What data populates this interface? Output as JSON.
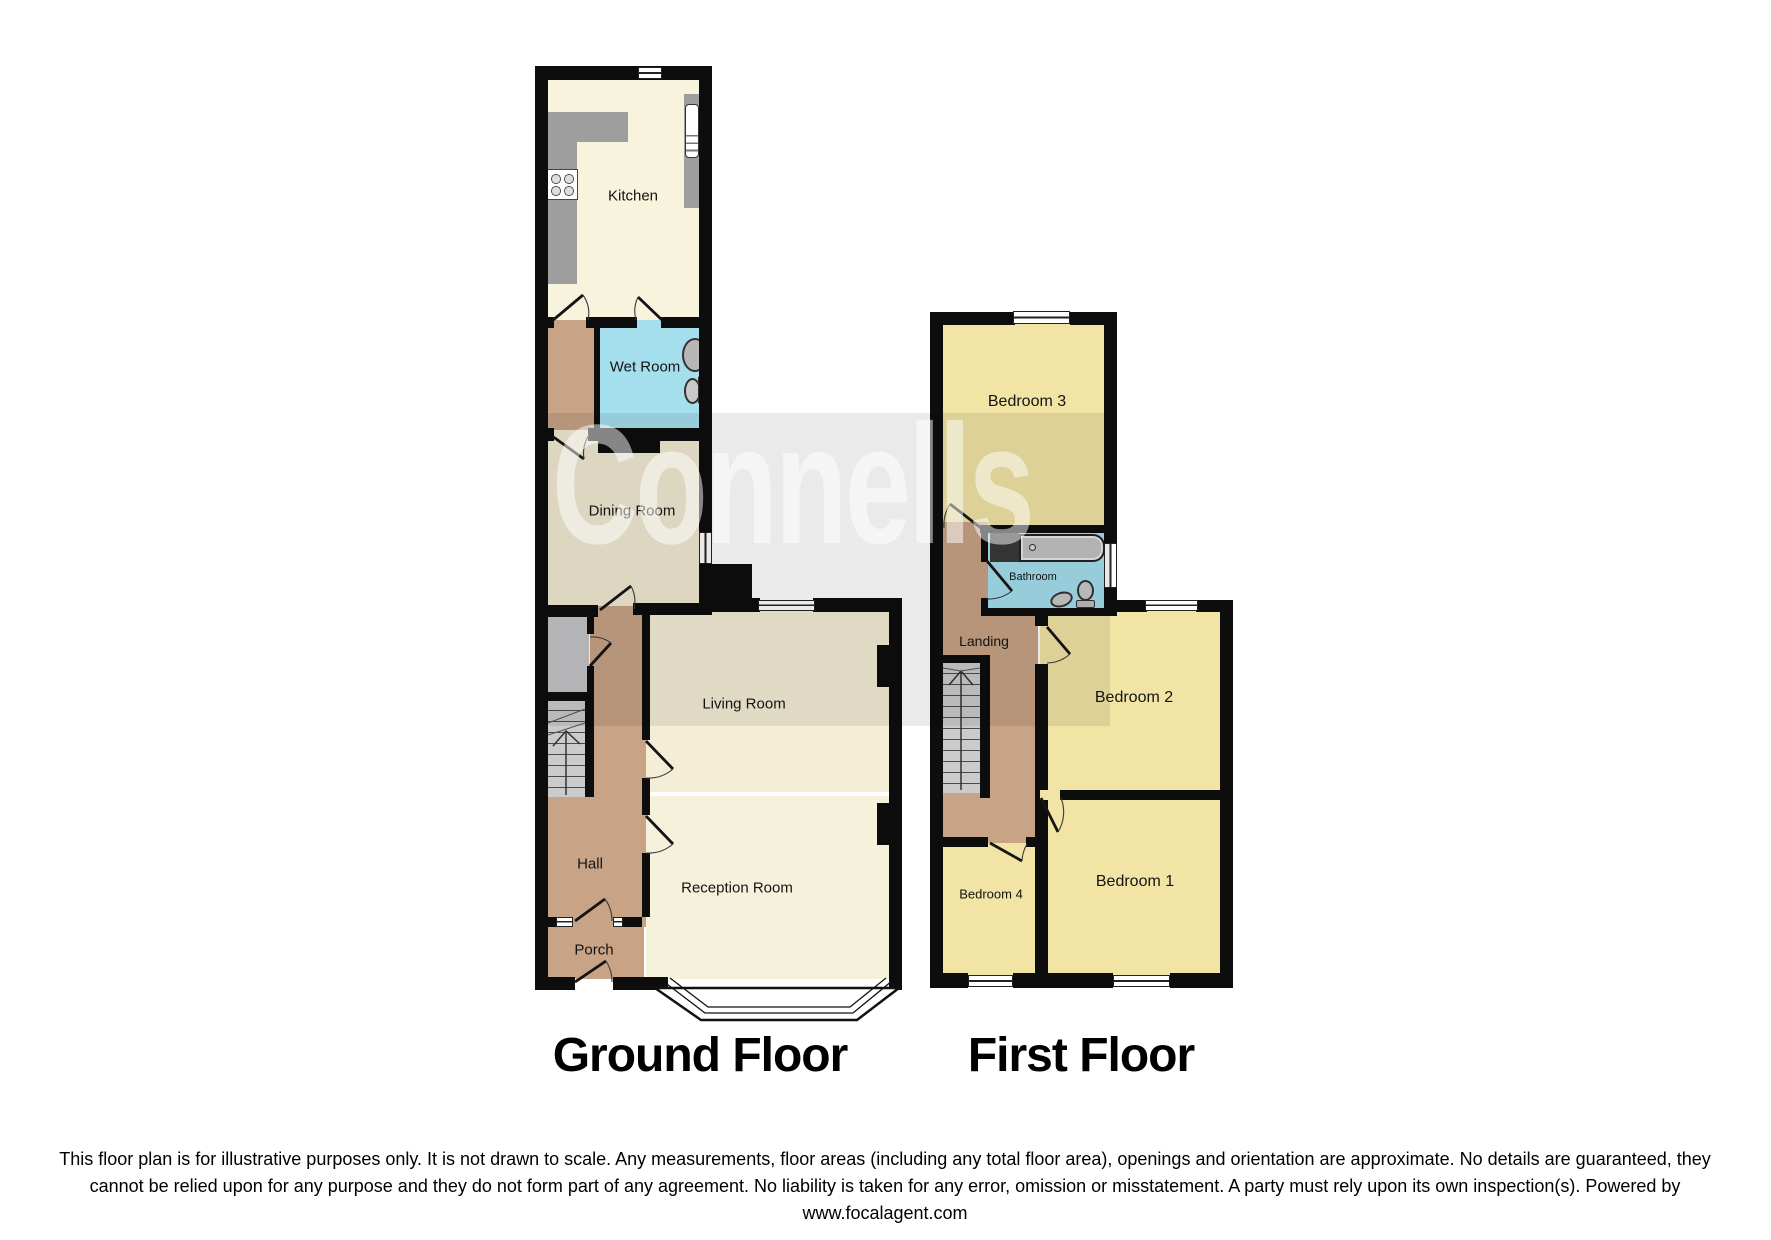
{
  "watermark": {
    "text": "Connells"
  },
  "titles": {
    "ground": "Ground Floor",
    "first": "First Floor"
  },
  "ground_floor": {
    "rooms": {
      "kitchen": "Kitchen",
      "wet_room": "Wet Room",
      "dining_room": "Dining Room",
      "living_room": "Living Room",
      "hall": "Hall",
      "reception_room": "Reception Room",
      "porch": "Porch"
    }
  },
  "first_floor": {
    "rooms": {
      "bedroom3": "Bedroom 3",
      "bathroom": "Bathroom",
      "landing": "Landing",
      "bedroom2": "Bedroom 2",
      "bedroom1": "Bedroom 1",
      "bedroom4": "Bedroom 4"
    }
  },
  "disclaimer": "This floor plan is for illustrative purposes only. It is not drawn to scale. Any measurements, floor areas (including any total floor area), openings and orientation are approximate. No details are guaranteed, they cannot be relied upon for any purpose and they do not form part of any agreement. No liability is taken for any error, omission or misstatement. A party must rely upon its own inspection(s). Powered by www.focalagent.com",
  "colors": {
    "wall": "#0d0d0d",
    "cream": "#F6F1DA",
    "cream_light": "#F8F3DC",
    "cream_dark": "#F1EBD4",
    "cream_mid": "#F4EED7",
    "brown": "#C8A385",
    "blue": "#A5DFEE",
    "yellow": "#F1E4A5",
    "counter_gray": "#9E9E9E",
    "stair_gray": "#CBCBCB",
    "closet_gray": "#C4C4C8"
  }
}
